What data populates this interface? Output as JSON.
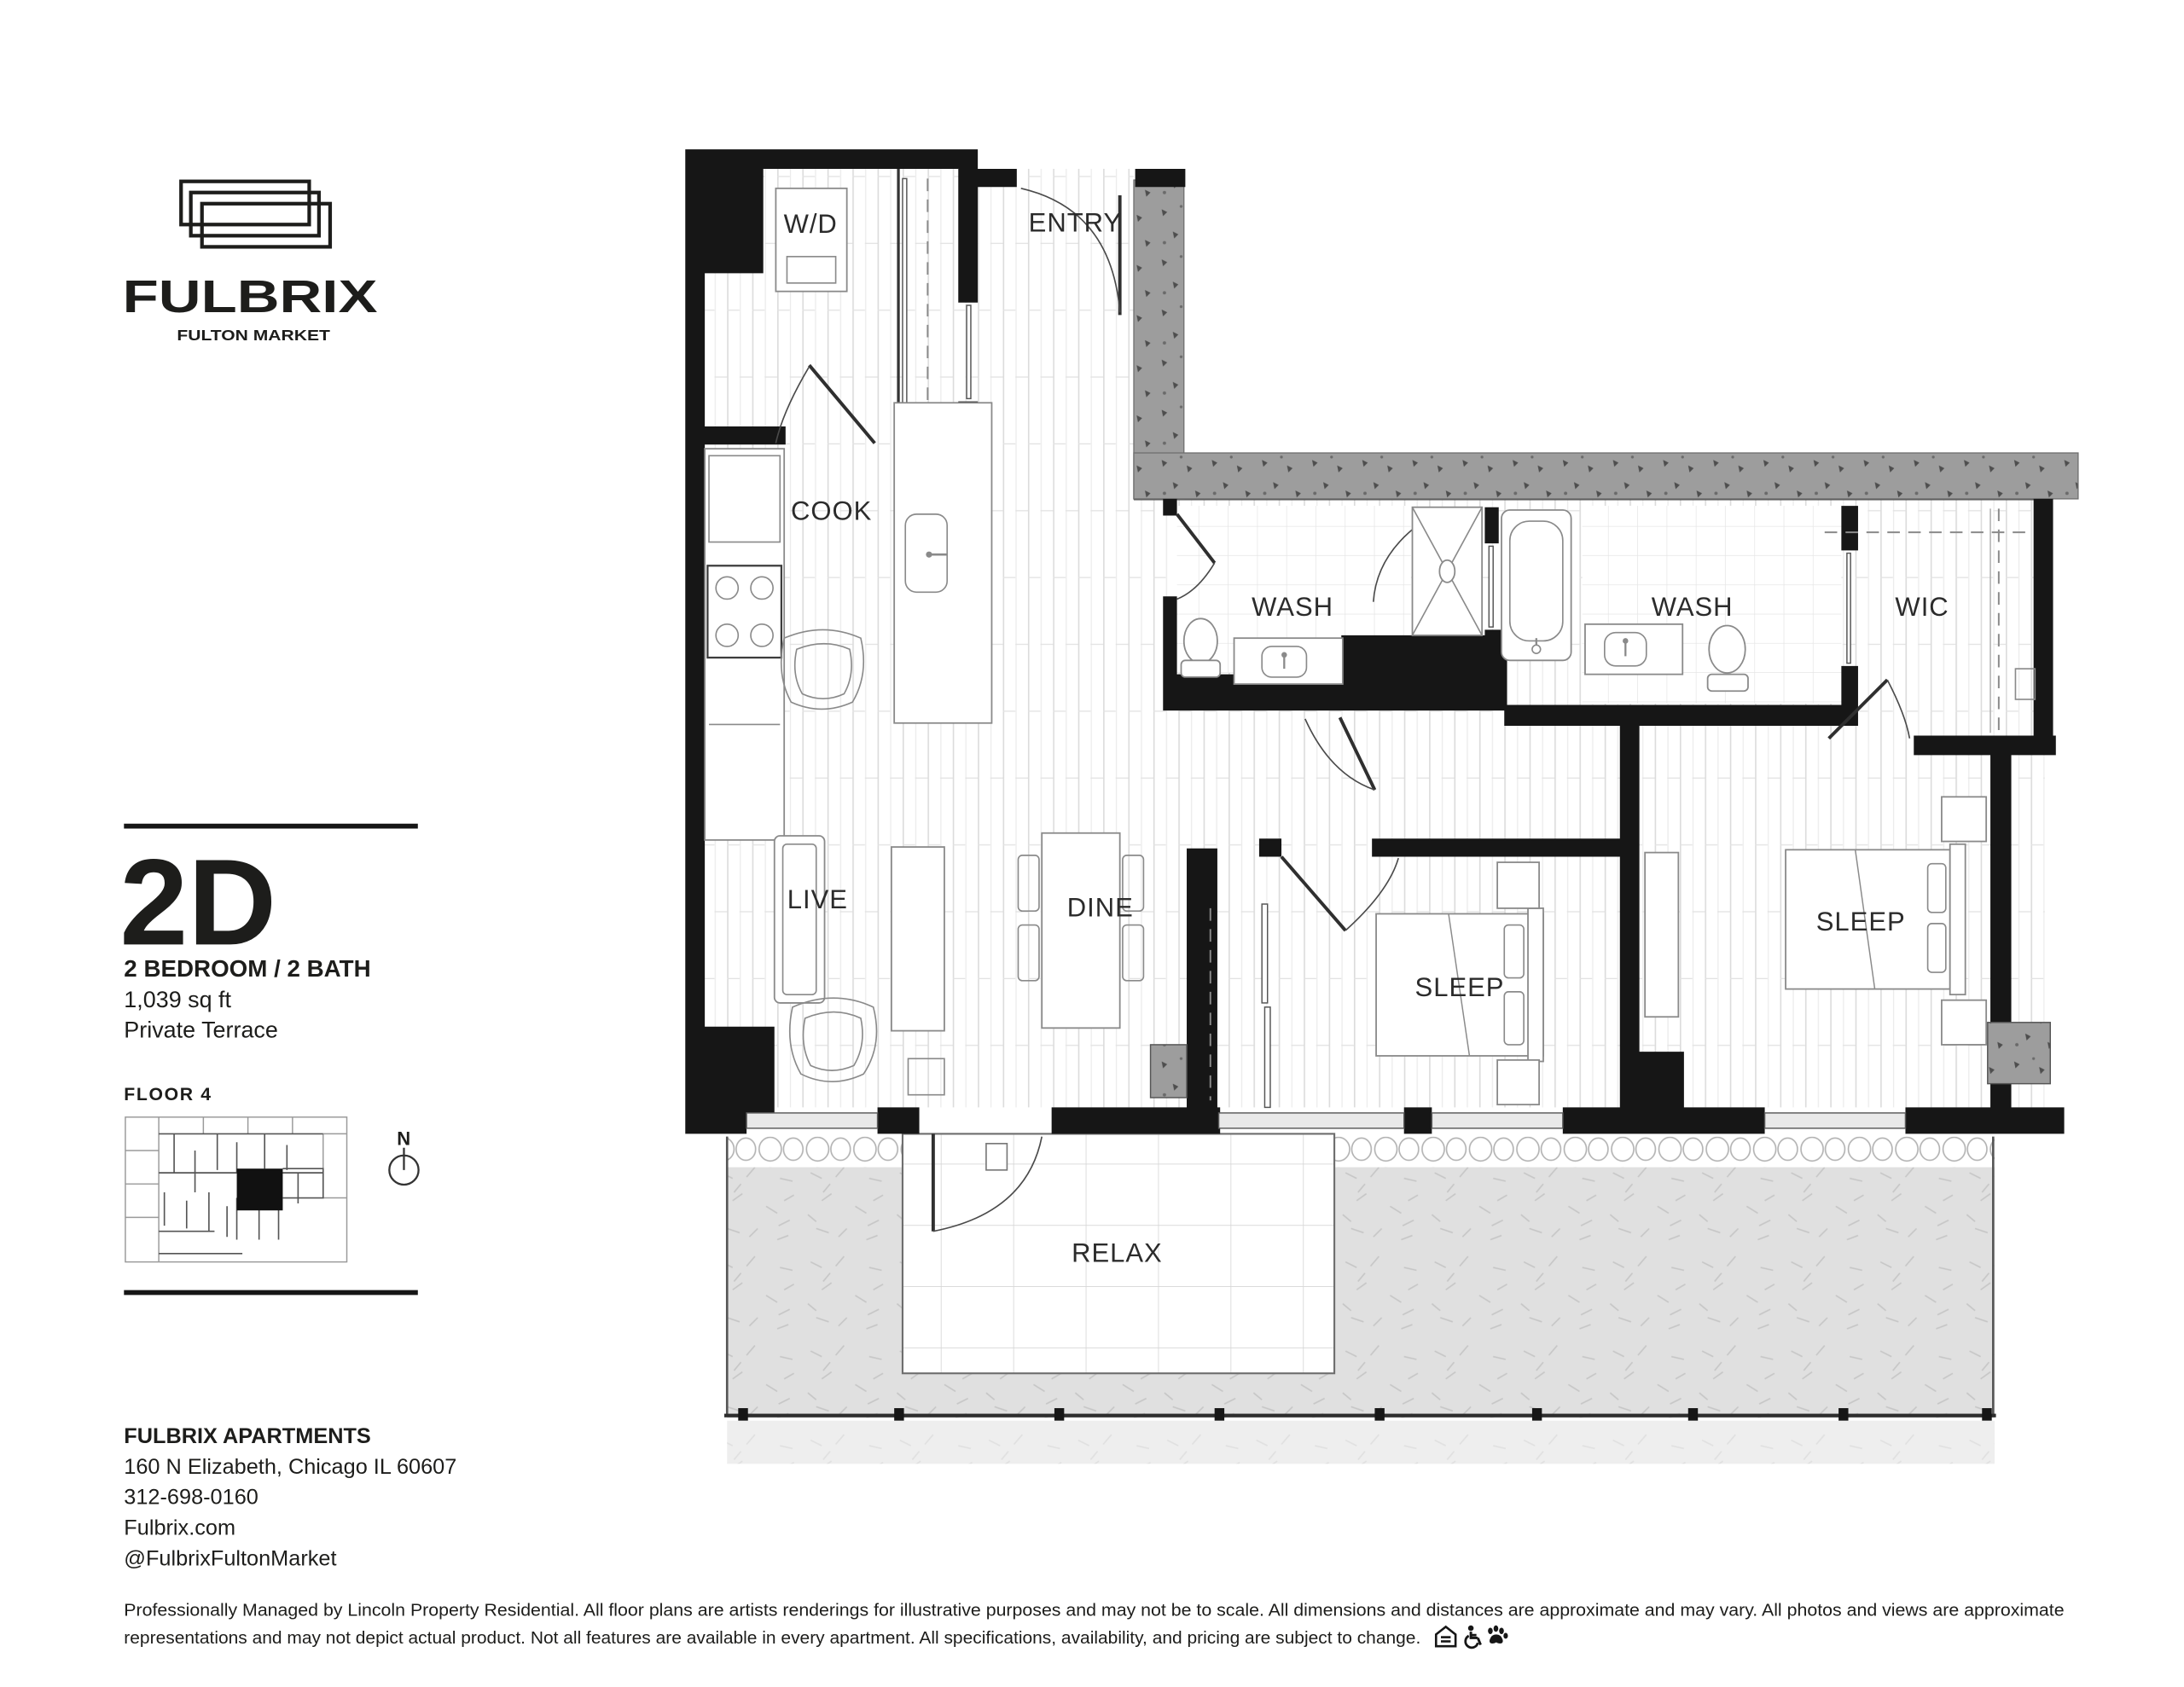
{
  "logo": {
    "brand": "FULBRIX",
    "tagline": "FULTON MARKET",
    "icon": "stacked-rectangles-icon",
    "color": "#1d1d1b"
  },
  "unit": {
    "code": "2D",
    "type": "2 BEDROOM / 2 BATH",
    "area": "1,039 sq ft",
    "feature": "Private Terrace",
    "floor": "FLOOR 4",
    "compass": "N"
  },
  "floorplan": {
    "rooms": {
      "wd": "W/D",
      "entry": "ENTRY",
      "cook": "COOK",
      "wash1": "WASH",
      "wash2": "WASH",
      "wic": "WIC",
      "live": "LIVE",
      "dine": "DINE",
      "sleep1": "SLEEP",
      "sleep2": "SLEEP",
      "relax": "RELAX"
    },
    "wall_color": "#161616",
    "terrace_concrete_color": "#9d9d9d",
    "terrace_lawn_color": "#e0e0e0"
  },
  "contact": {
    "name": "FULBRIX APARTMENTS",
    "address": "160 N Elizabeth, Chicago IL 60607",
    "phone": "312-698-0160",
    "website": "Fulbrix.com",
    "social": "@FulbrixFultonMarket"
  },
  "disclaimer": {
    "line1": "Professionally Managed by Lincoln Property Residential. All floor plans are artists renderings for illustrative purposes and may not be to scale. All dimensions and distances are approximate and may vary. All photos and views are approximate",
    "line2": "representations and may not depict actual product. Not all features are available in every apartment. All specifications, availability, and pricing are subject to change.",
    "icons": [
      "equal-housing-icon",
      "accessibility-icon",
      "pet-friendly-icon"
    ]
  }
}
